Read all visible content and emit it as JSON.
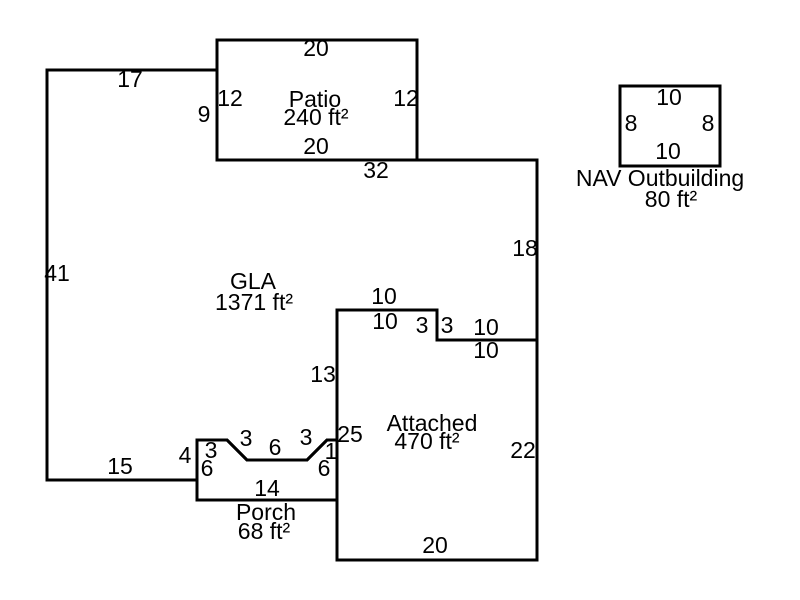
{
  "sketch": {
    "canvas": {
      "width": 800,
      "height": 600,
      "background_color": "#ffffff",
      "line_color": "#000000",
      "text_color": "#000000"
    },
    "scale_px_per_ft": 10,
    "regions": [
      {
        "id": "gla",
        "title": "GLA",
        "area_text": "1371 ft²",
        "label_lines": [
          {
            "text": "GLA",
            "x": 253,
            "y": 281
          },
          {
            "text": "1371 ft²",
            "x": 254,
            "y": 302
          }
        ],
        "points": [
          [
            47,
            70
          ],
          [
            217,
            70
          ],
          [
            217,
            160
          ],
          [
            537,
            160
          ],
          [
            537,
            340
          ],
          [
            437,
            340
          ],
          [
            437,
            310
          ],
          [
            337,
            310
          ],
          [
            337,
            440
          ],
          [
            327,
            440
          ],
          [
            307,
            460
          ],
          [
            247,
            460
          ],
          [
            227,
            440
          ],
          [
            197,
            440
          ],
          [
            197,
            480
          ],
          [
            47,
            480
          ]
        ],
        "dims": [
          {
            "text": "17",
            "x": 130,
            "y": 79
          },
          {
            "text": "9",
            "x": 204,
            "y": 114
          },
          {
            "text": "32",
            "x": 376,
            "y": 170
          },
          {
            "text": "18",
            "x": 525,
            "y": 248
          },
          {
            "text": "10",
            "x": 384,
            "y": 296
          },
          {
            "text": "3",
            "x": 422,
            "y": 325
          },
          {
            "text": "10",
            "x": 486,
            "y": 327
          },
          {
            "text": "13",
            "x": 323,
            "y": 374
          },
          {
            "text": "1",
            "x": 331,
            "y": 451
          },
          {
            "text": "3",
            "x": 306,
            "y": 437
          },
          {
            "text": "6",
            "x": 275,
            "y": 447
          },
          {
            "text": "3",
            "x": 246,
            "y": 438
          },
          {
            "text": "3",
            "x": 211,
            "y": 450
          },
          {
            "text": "4",
            "x": 185,
            "y": 455
          },
          {
            "text": "15",
            "x": 120,
            "y": 466
          },
          {
            "text": "41",
            "x": 57,
            "y": 273
          }
        ]
      },
      {
        "id": "patio",
        "title": "Patio",
        "area_text": "240 ft²",
        "label_lines": [
          {
            "text": "Patio",
            "x": 315,
            "y": 99
          },
          {
            "text": "240 ft²",
            "x": 316,
            "y": 117
          }
        ],
        "points": [
          [
            217,
            40
          ],
          [
            417,
            40
          ],
          [
            417,
            160
          ],
          [
            217,
            160
          ]
        ],
        "dims": [
          {
            "text": "20",
            "x": 316,
            "y": 48
          },
          {
            "text": "12",
            "x": 230,
            "y": 98
          },
          {
            "text": "12",
            "x": 406,
            "y": 98
          },
          {
            "text": "20",
            "x": 316,
            "y": 146
          }
        ]
      },
      {
        "id": "attached-garage",
        "title": "Attached",
        "area_text": "470 ft²",
        "label_lines": [
          {
            "text": "Attached",
            "x": 432,
            "y": 423
          },
          {
            "text": "470 ft²",
            "x": 427,
            "y": 441
          }
        ],
        "points": [
          [
            337,
            310
          ],
          [
            437,
            310
          ],
          [
            437,
            340
          ],
          [
            537,
            340
          ],
          [
            537,
            560
          ],
          [
            337,
            560
          ]
        ],
        "dims": [
          {
            "text": "10",
            "x": 385,
            "y": 321
          },
          {
            "text": "3",
            "x": 447,
            "y": 325
          },
          {
            "text": "10",
            "x": 486,
            "y": 350
          },
          {
            "text": "25",
            "x": 350,
            "y": 434
          },
          {
            "text": "22",
            "x": 523,
            "y": 450
          },
          {
            "text": "20",
            "x": 435,
            "y": 545
          }
        ]
      },
      {
        "id": "porch",
        "title": "Porch",
        "area_text": "68 ft²",
        "label_lines": [
          {
            "text": "Porch",
            "x": 266,
            "y": 512
          },
          {
            "text": "68 ft²",
            "x": 264,
            "y": 531
          }
        ],
        "points": [
          [
            197,
            440
          ],
          [
            227,
            440
          ],
          [
            247,
            460
          ],
          [
            307,
            460
          ],
          [
            327,
            440
          ],
          [
            337,
            440
          ],
          [
            337,
            500
          ],
          [
            197,
            500
          ]
        ],
        "dims": [
          {
            "text": "6",
            "x": 207,
            "y": 468
          },
          {
            "text": "6",
            "x": 324,
            "y": 468
          },
          {
            "text": "14",
            "x": 267,
            "y": 488
          }
        ]
      },
      {
        "id": "nav-outbuilding",
        "title": "NAV Outbuilding",
        "area_text": "80 ft²",
        "label_lines": [
          {
            "text": "NAV Outbuilding",
            "x": 660,
            "y": 178
          },
          {
            "text": "80 ft²",
            "x": 671,
            "y": 199
          }
        ],
        "points": [
          [
            620,
            86
          ],
          [
            720,
            86
          ],
          [
            720,
            166
          ],
          [
            620,
            166
          ]
        ],
        "dims": [
          {
            "text": "10",
            "x": 669,
            "y": 97
          },
          {
            "text": "8",
            "x": 631,
            "y": 123
          },
          {
            "text": "8",
            "x": 708,
            "y": 123
          },
          {
            "text": "10",
            "x": 668,
            "y": 151
          }
        ]
      }
    ]
  }
}
